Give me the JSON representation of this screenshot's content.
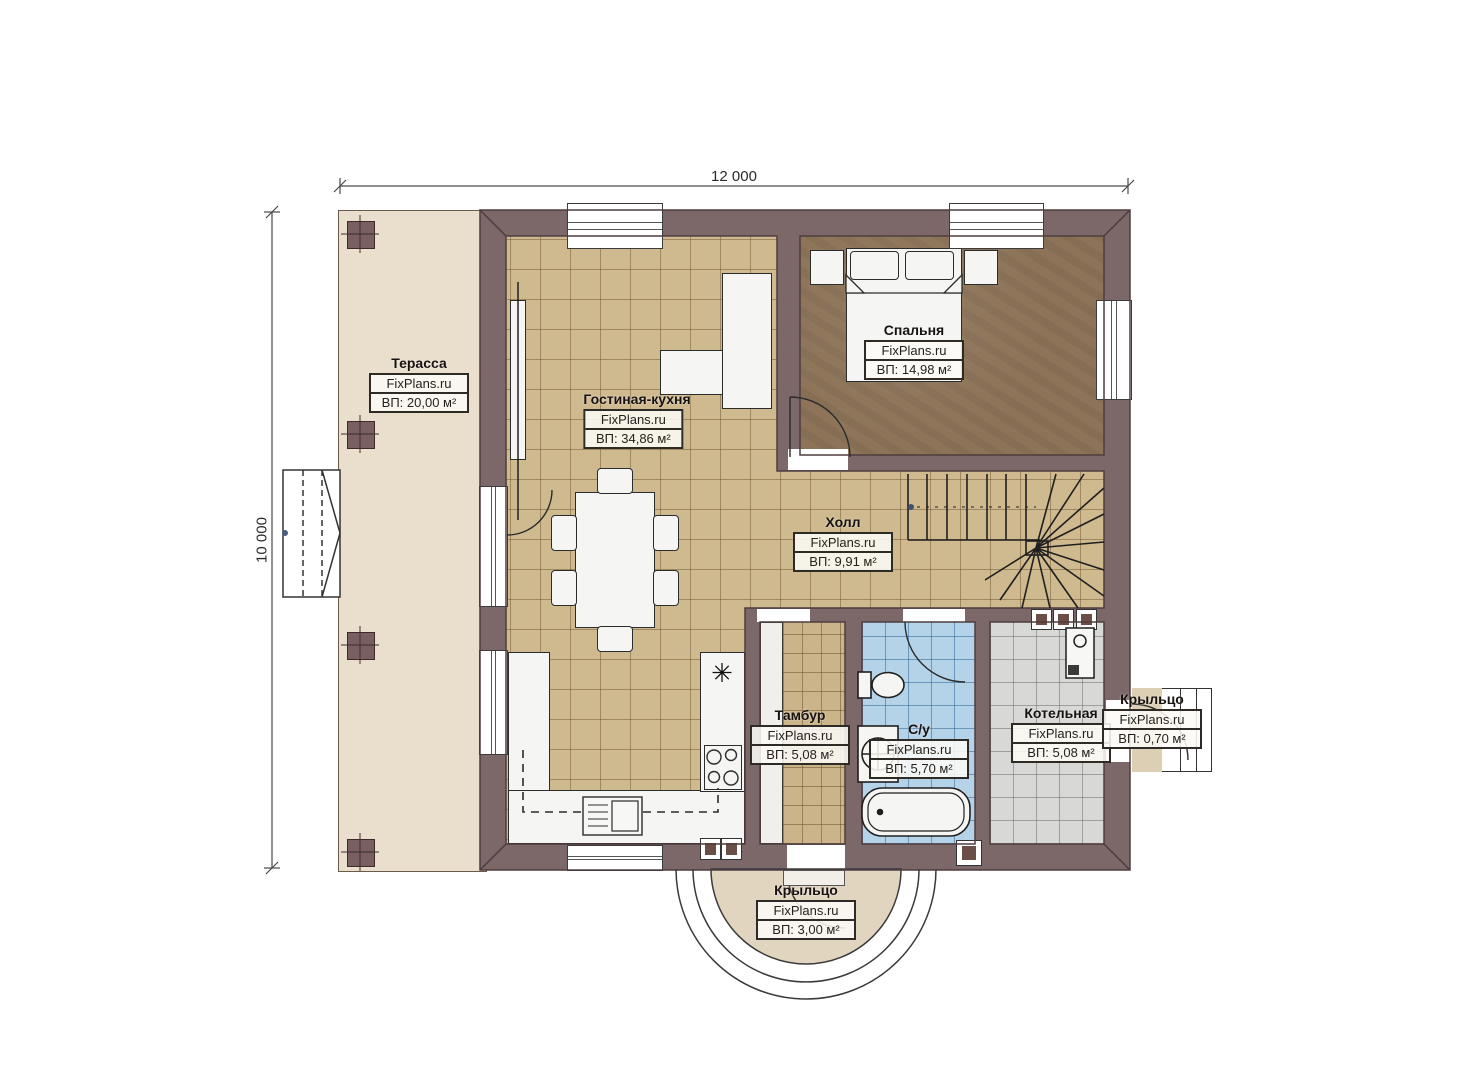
{
  "dimensions": {
    "width_label": "12 000",
    "height_label": "10 000"
  },
  "watermark": "FixPlans.ru",
  "rooms": [
    {
      "id": "terrace",
      "name": "Терасса",
      "area": "ВП: 20,00 м²"
    },
    {
      "id": "living-kitchen",
      "name": "Гостиная-кухня",
      "area": "ВП: 34,86 м²"
    },
    {
      "id": "bedroom",
      "name": "Спальня",
      "area": "ВП: 14,98 м²"
    },
    {
      "id": "hall",
      "name": "Холл",
      "area": "ВП: 9,91 м²"
    },
    {
      "id": "vestibule",
      "name": "Тамбур",
      "area": "ВП: 5,08 м²"
    },
    {
      "id": "bathroom",
      "name": "С/у",
      "area": "ВП: 5,70 м²"
    },
    {
      "id": "boiler-room",
      "name": "Котельная",
      "area": "ВП: 5,08 м²"
    },
    {
      "id": "porch-right",
      "name": "Крыльцо",
      "area": "ВП: 0,70 м²"
    },
    {
      "id": "porch-front",
      "name": "Крыльцо",
      "area": "ВП: 3,00 м²"
    }
  ],
  "symbols": {
    "fridge_asterisk": "✳"
  }
}
